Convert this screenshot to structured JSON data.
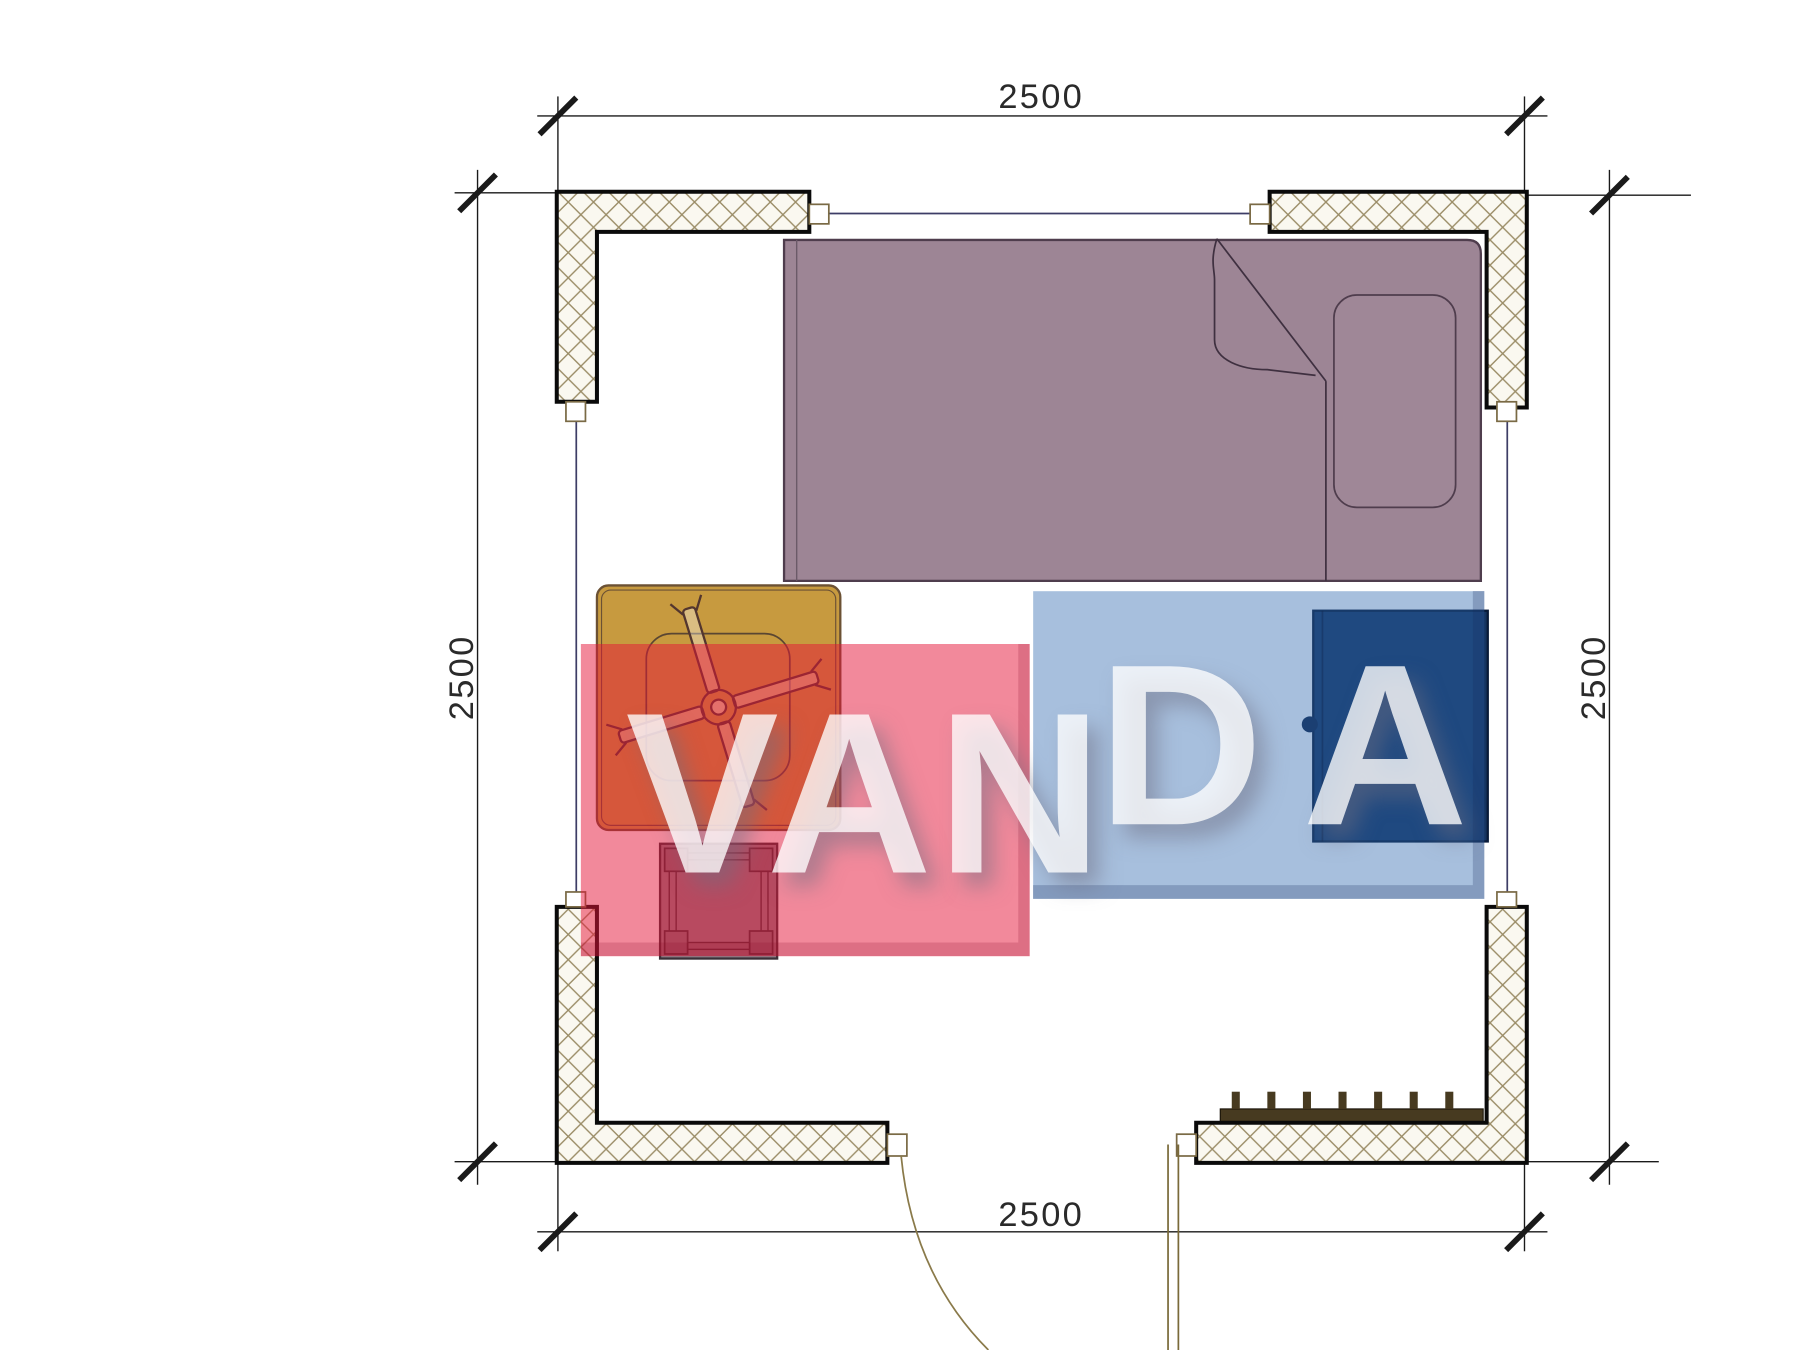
{
  "dimensions": {
    "top": {
      "label": "2500"
    },
    "bottom": {
      "label": "2500"
    },
    "left": {
      "label": "2500"
    },
    "right": {
      "label": "2500"
    }
  },
  "watermark": {
    "word": "VANDA",
    "part1": "VAN",
    "part2": "DA",
    "red_block_color": "#e51337",
    "blue_block_color": "#2e67ae",
    "text_color": "#ffffff"
  },
  "plan": {
    "furniture_icons": [
      "bed-icon",
      "pillow-icon",
      "blanket-fold-icon",
      "table-icon",
      "ceiling-fan-icon",
      "stool-icon",
      "wardrobe-icon",
      "radiator-icon",
      "door-icon"
    ],
    "colors": {
      "bed": "#9d8595",
      "table": "#c79a3f",
      "wardrobe": "#153460",
      "stool": "#8a8088",
      "wall_hatch": "#9a8c66",
      "window_line": "#3d3d66",
      "door_line": "#7a6a3a"
    }
  }
}
